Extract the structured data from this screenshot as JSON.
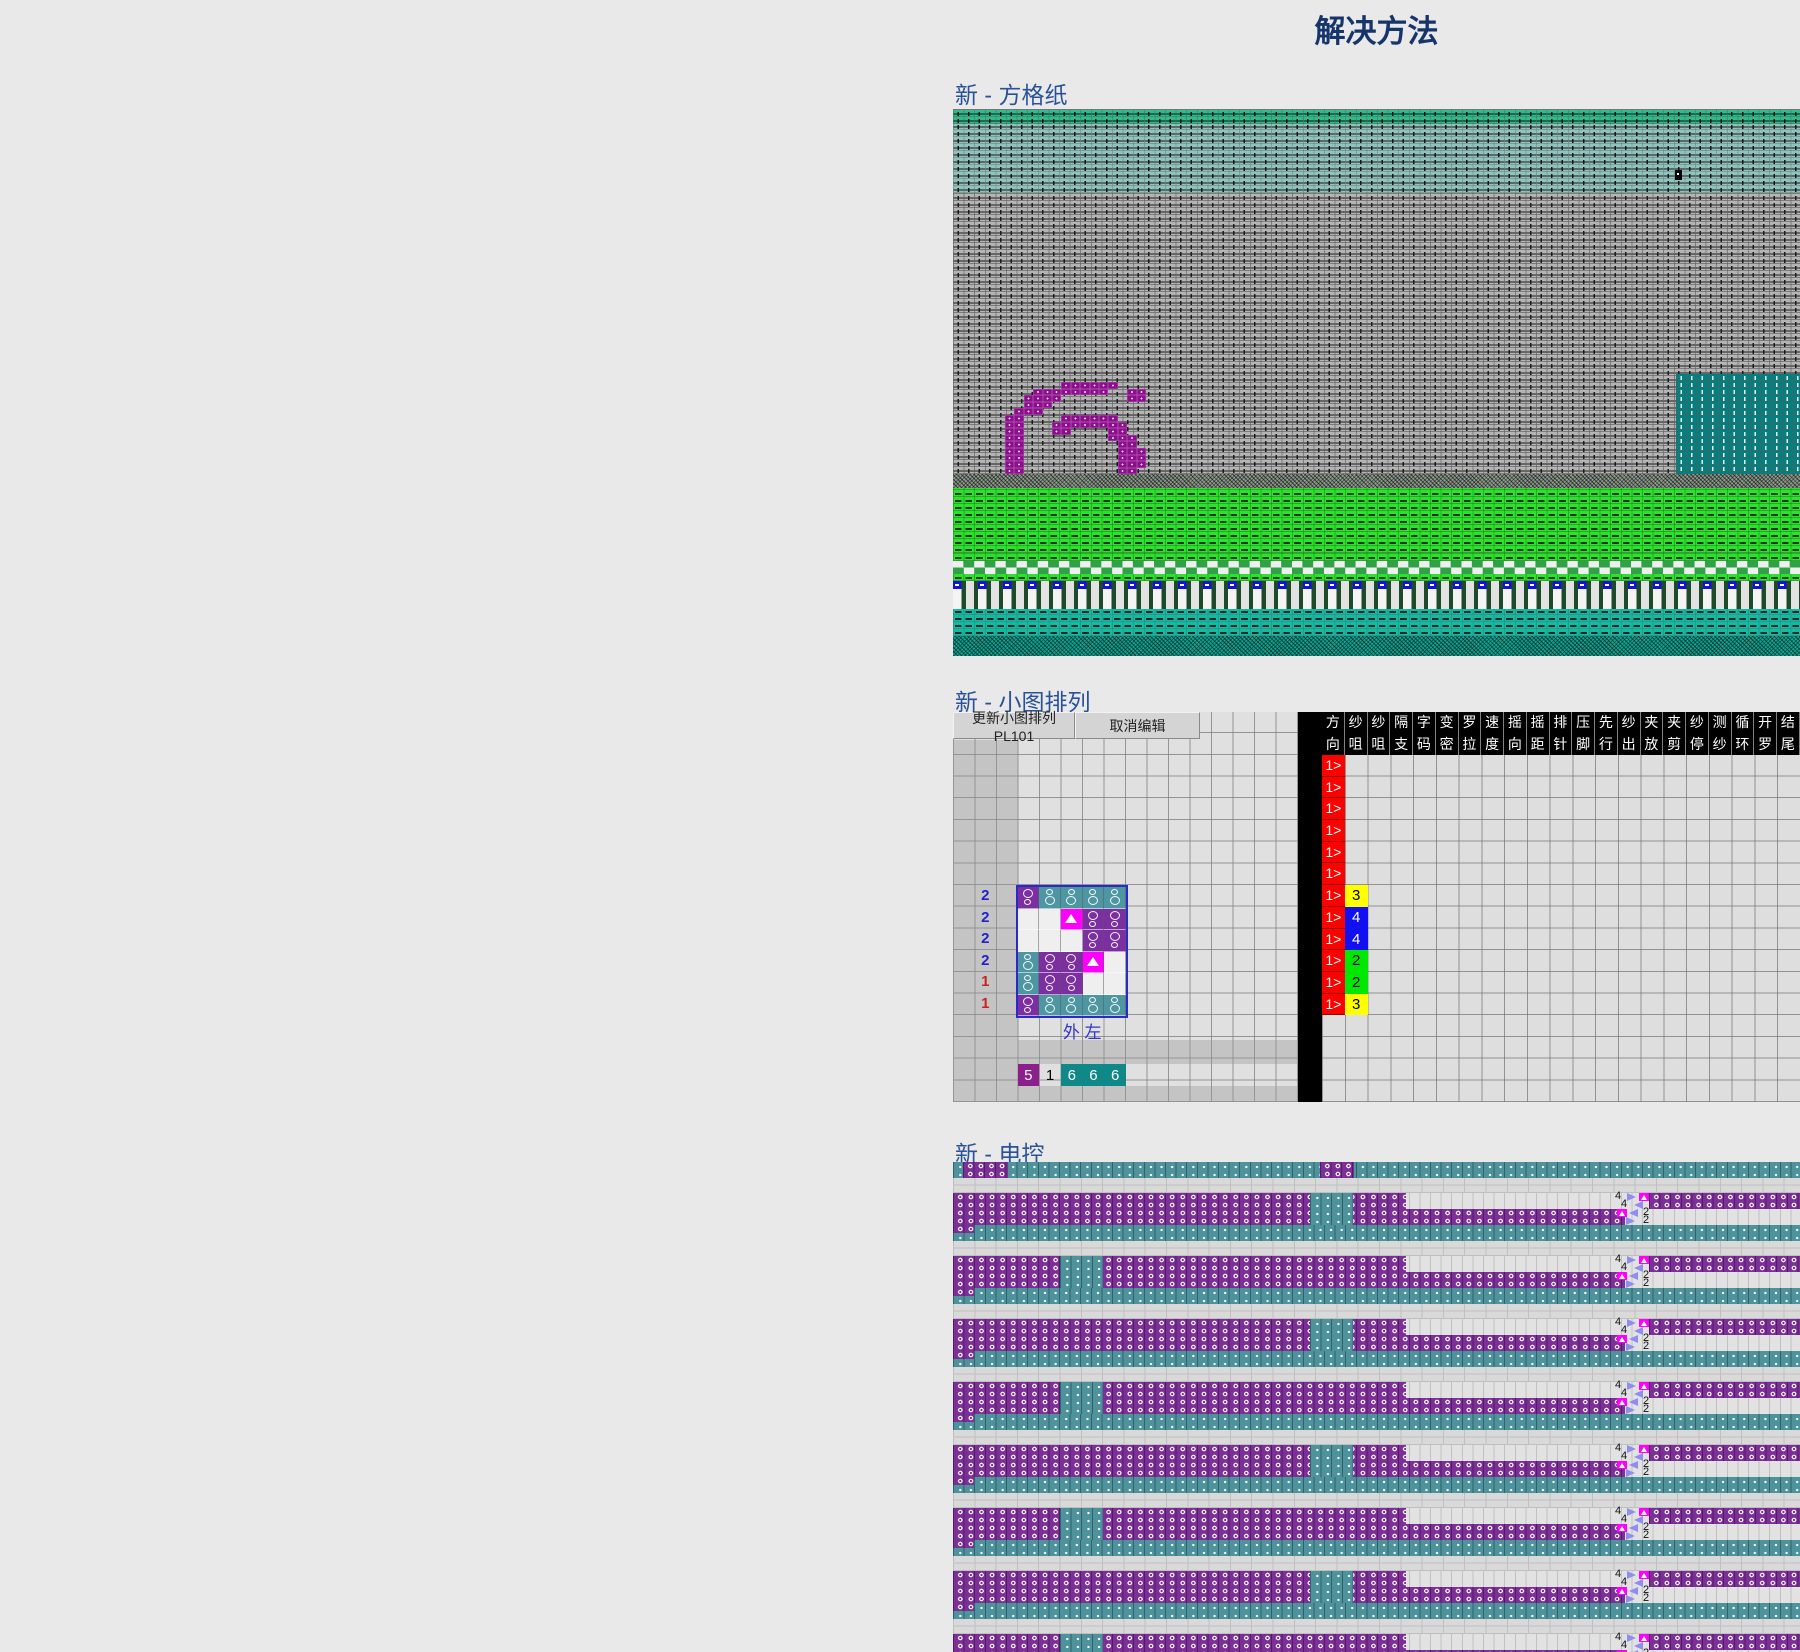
{
  "title": "解决方法",
  "colors": {
    "title_text": "#15356B",
    "section_label_text": "#2A5298",
    "grid_purple": "#8E0D8E",
    "grid_teal_block": "#047F80",
    "band_green_top": "#2CBD8C",
    "band_light_teal": "#90C3BD",
    "band_gray": "#B4B4B4",
    "band_bright_green": "#2BE32B",
    "band_blue_bar": "#1312DC",
    "band_teal_bottom": "#12BCA4",
    "red_direction": "#FB0200",
    "yarn_yellow": "#FFFF00",
    "yarn_blue": "#1010F0",
    "yarn_green": "#00E800",
    "pattern_purple": "#7B2FA0",
    "pattern_teal": "#4F96A3",
    "pattern_magenta": "#FF00FF",
    "econtrol_purple": "#7C2F96",
    "econtrol_teal": "#4E929C"
  },
  "sections": {
    "grid_paper": {
      "label": "新 - 方格纸",
      "digit": {
        "value": "6",
        "bitmap": [
          "......######...",
          "...########..##",
          "..####.......##",
          "..###..........",
          ".###...........",
          "##....######...",
          "##...########..",
          "##...##....##..",
          "##.........###.",
          "##..........##.",
          "##..........###",
          "##..........###",
          "##..........###",
          "##..........##.",
          "###.........##.",
          ".##.........##.",
          ".###.......###.",
          "..####....####.",
          "...#########...",
          "....#######...."
        ]
      }
    },
    "small_arrangement": {
      "label": "新 - 小图排列",
      "toolbar": {
        "update_button": "更新小图排列 PL101",
        "cancel_button": "取消编辑"
      },
      "table": {
        "column_headers": [
          [
            "方",
            "向"
          ],
          [
            "纱",
            "咀"
          ],
          [
            "纱",
            "咀"
          ],
          [
            "隔",
            "支"
          ],
          [
            "字",
            "码"
          ],
          [
            "变",
            "密"
          ],
          [
            "罗",
            "拉"
          ],
          [
            "速",
            "度"
          ],
          [
            "摇",
            "向"
          ],
          [
            "摇",
            "距"
          ],
          [
            "排",
            "针"
          ],
          [
            "压",
            "脚"
          ],
          [
            "先",
            "行"
          ],
          [
            "纱",
            "出"
          ],
          [
            "夹",
            "放"
          ],
          [
            "夹",
            "剪"
          ],
          [
            "纱",
            "停"
          ],
          [
            "测",
            "纱"
          ],
          [
            "循",
            "环"
          ],
          [
            "开",
            "罗"
          ],
          [
            "结",
            "尾"
          ]
        ],
        "direction_symbol": "1>",
        "rows": [
          {
            "yarn": "",
            "color": ""
          },
          {
            "yarn": "",
            "color": ""
          },
          {
            "yarn": "",
            "color": ""
          },
          {
            "yarn": "",
            "color": ""
          },
          {
            "yarn": "",
            "color": ""
          },
          {
            "yarn": "",
            "color": ""
          },
          {
            "yarn": "3",
            "color": "yellow"
          },
          {
            "yarn": "4",
            "color": "blue"
          },
          {
            "yarn": "4",
            "color": "blue"
          },
          {
            "yarn": "2",
            "color": "green"
          },
          {
            "yarn": "2",
            "color": "green"
          },
          {
            "yarn": "3",
            "color": "yellow"
          }
        ]
      },
      "pattern": {
        "row_labels": [
          {
            "text": "2",
            "color": "#2222CC"
          },
          {
            "text": "2",
            "color": "#2222CC"
          },
          {
            "text": "2",
            "color": "#2222CC"
          },
          {
            "text": "2",
            "color": "#2222CC"
          },
          {
            "text": "1",
            "color": "#CC2222"
          },
          {
            "text": "1",
            "color": "#CC2222"
          }
        ],
        "grid": [
          "PTTTT",
          "WWMPP",
          "WWWPP",
          "TPPMW",
          "TPPWW",
          "PTTTT"
        ],
        "legend": {
          "P": "purple-stitch",
          "T": "teal-stitch",
          "M": "magenta-transfer",
          "W": "empty"
        },
        "footer": [
          "外",
          "左"
        ],
        "number_cells": [
          {
            "value": "5",
            "style": "purple"
          },
          {
            "value": "1",
            "style": "plain"
          },
          {
            "value": "6",
            "style": "teal"
          },
          {
            "value": "6",
            "style": "teal"
          },
          {
            "value": "6",
            "style": "teal"
          }
        ]
      }
    },
    "econtrol": {
      "label": "新 - 电控",
      "block_count": 8,
      "markers": {
        "carriage_out": "4",
        "carriage_back": "4",
        "left_out": "2",
        "left_back": "2"
      }
    }
  }
}
